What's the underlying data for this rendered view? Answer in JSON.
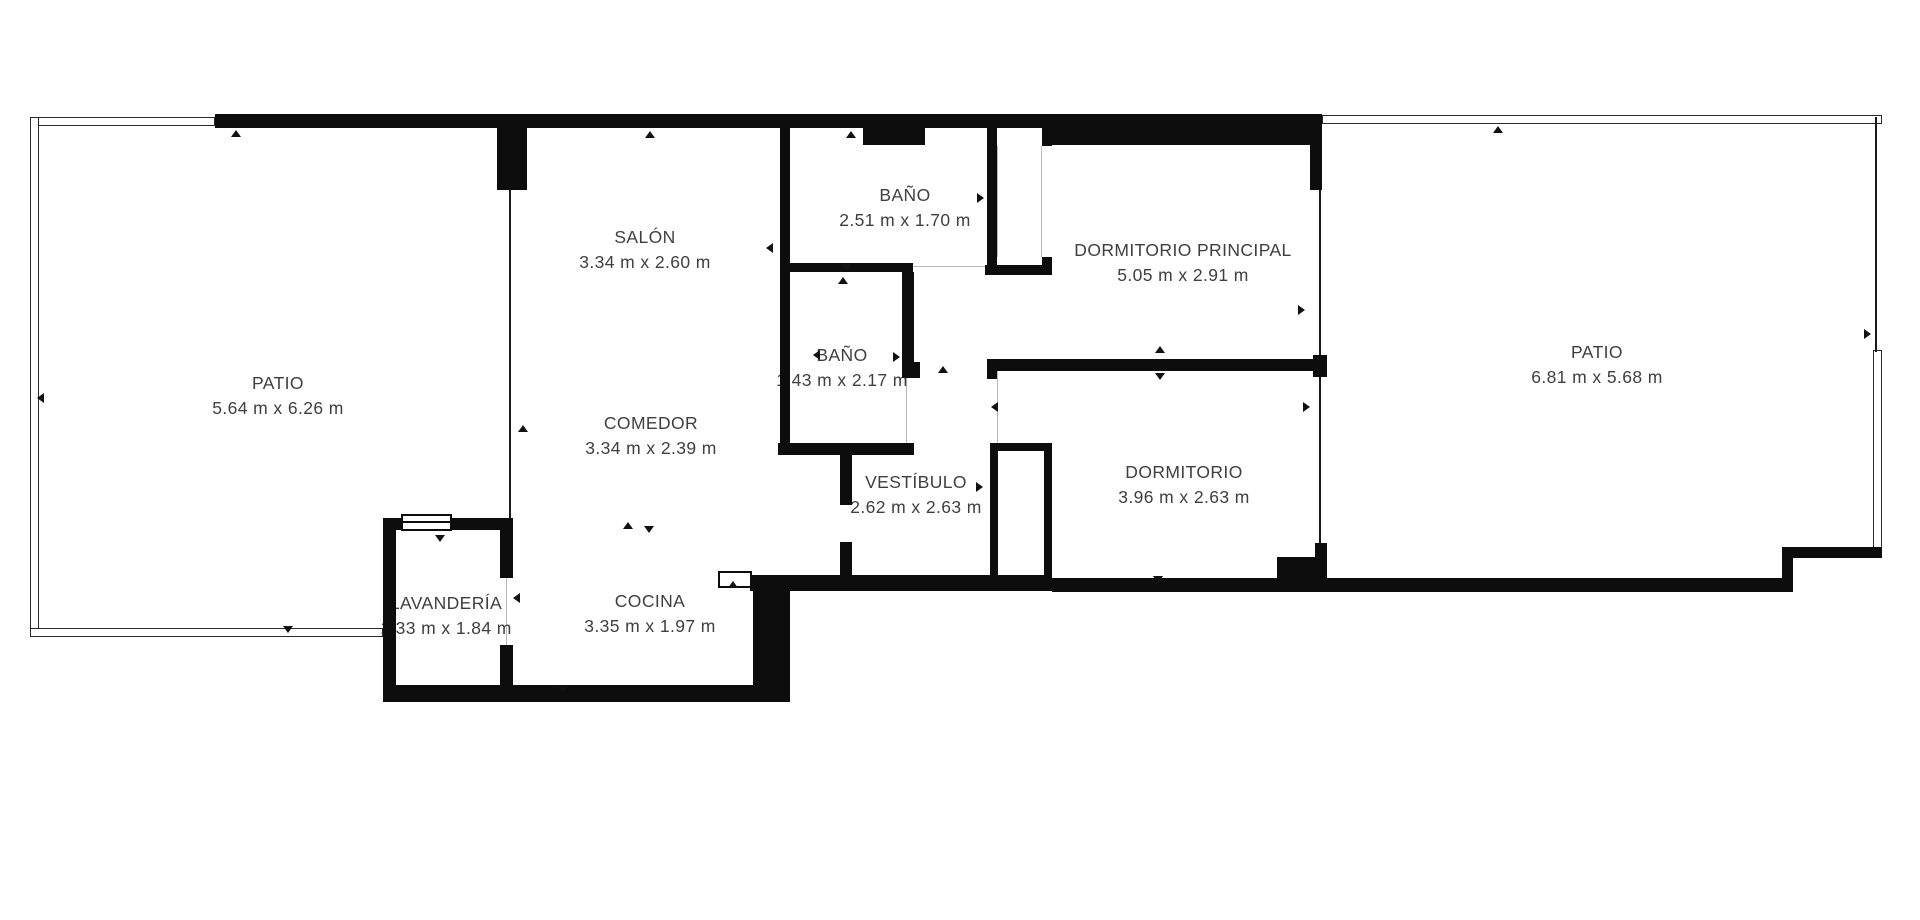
{
  "page": {
    "background_color": "#ffffff",
    "wall_color": "#0d0d0d",
    "label_text_color": "#3f3f3f",
    "plan_type": "apartment-floor-plan"
  },
  "rooms": [
    {
      "id": "patio-left",
      "name": "PATIO",
      "dimensions": "5.64 m x 6.26 m"
    },
    {
      "id": "salon",
      "name": "SALÓN",
      "dimensions": "3.34 m x 2.60 m"
    },
    {
      "id": "bano-1",
      "name": "BAÑO",
      "dimensions": "2.51 m x 1.70 m"
    },
    {
      "id": "dormitorio-principal",
      "name": "DORMITORIO PRINCIPAL",
      "dimensions": "5.05 m x 2.91 m"
    },
    {
      "id": "bano-2",
      "name": "BAÑO",
      "dimensions": "1.43 m x 2.17 m"
    },
    {
      "id": "comedor",
      "name": "COMEDOR",
      "dimensions": "3.34 m x 2.39 m"
    },
    {
      "id": "vestibulo",
      "name": "VESTÍBULO",
      "dimensions": "2.62 m x 2.63 m"
    },
    {
      "id": "dormitorio",
      "name": "DORMITORIO",
      "dimensions": "3.96 m x 2.63 m"
    },
    {
      "id": "patio-right",
      "name": "PATIO",
      "dimensions": "6.81 m x 5.68 m"
    },
    {
      "id": "lavanderia",
      "name": "LAVANDERÍA",
      "dimensions": "1.33 m x 1.84 m"
    },
    {
      "id": "cocina",
      "name": "COCINA",
      "dimensions": "3.35 m x 1.97 m"
    }
  ]
}
